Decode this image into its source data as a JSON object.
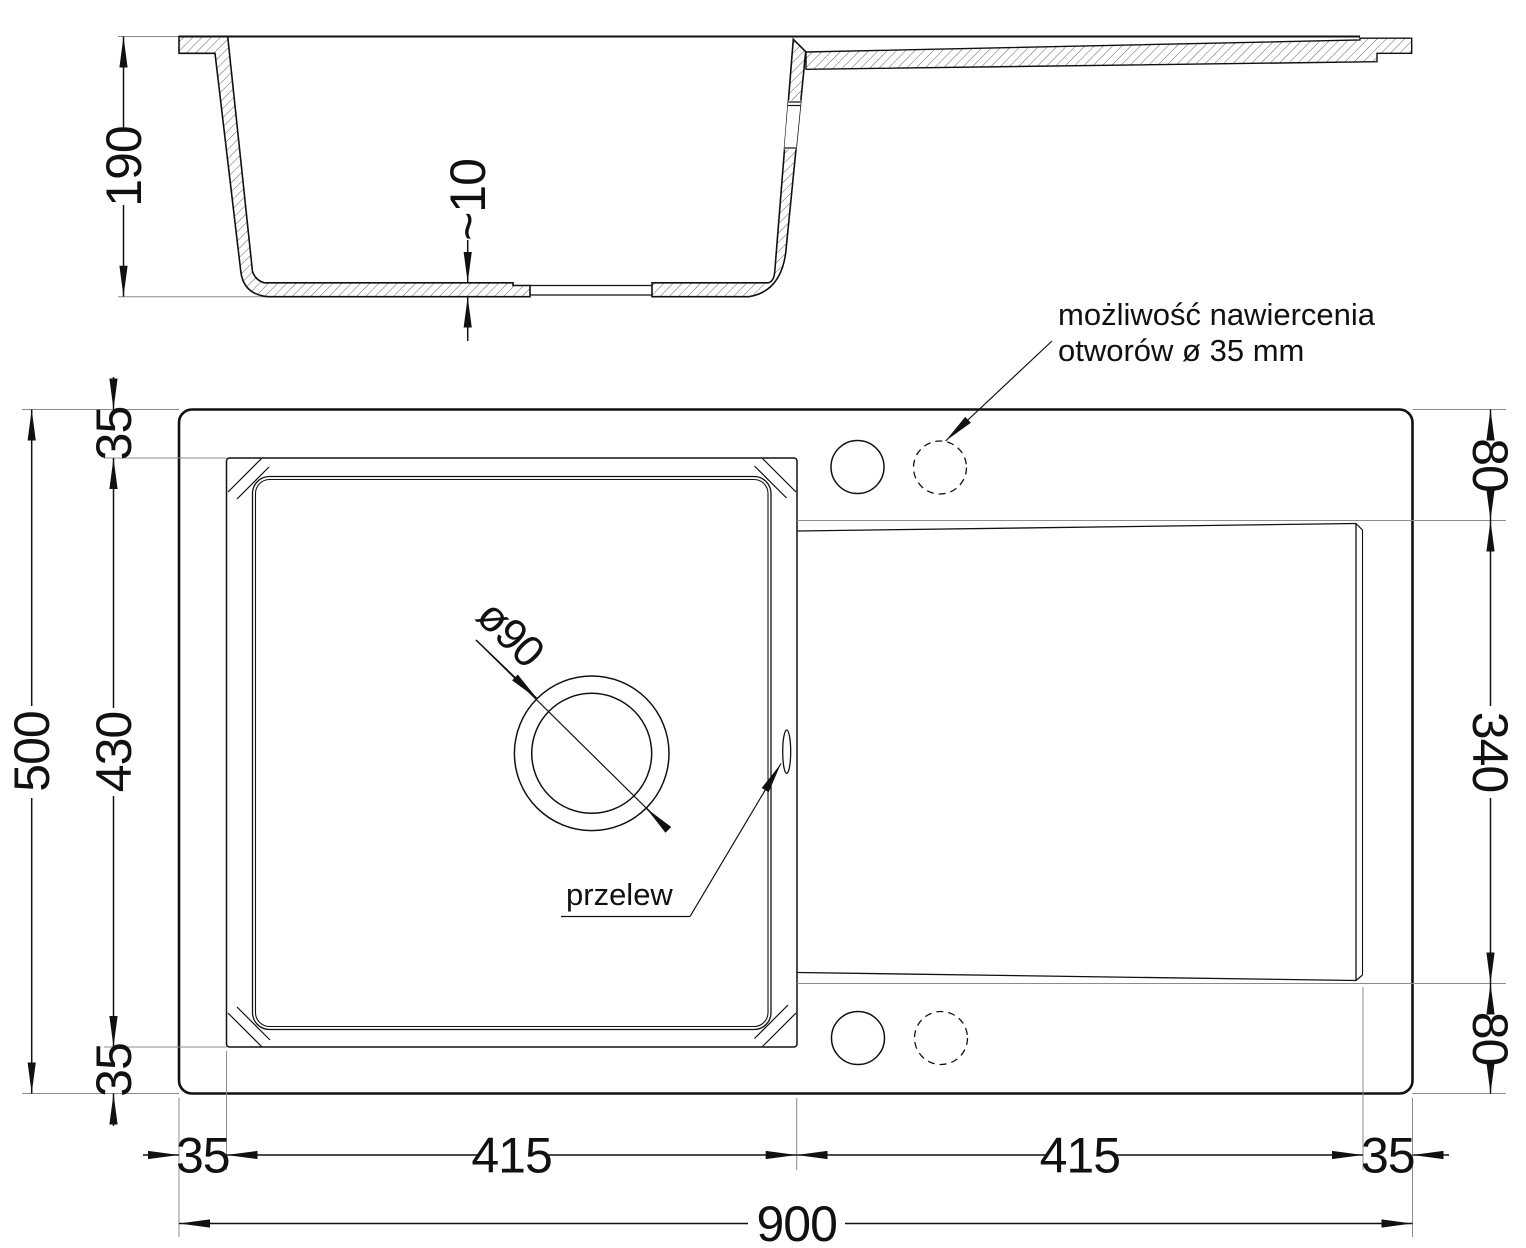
{
  "drawing": {
    "side_view": {
      "depth": "190",
      "bottom_thickness": "~10"
    },
    "plan_view": {
      "overflow_label": "przelew",
      "drain_diameter": "ø90",
      "drill_note_line1": "możliwość nawiercenia",
      "drill_note_line2": "otworów ø 35 mm"
    },
    "dimensions": {
      "total_width": "900",
      "total_height": "500",
      "bowl_width": "415",
      "drainer_width": "415",
      "left_margin": "35",
      "right_margin": "35",
      "top_margin": "35",
      "bottom_margin": "35",
      "bowl_height": "430",
      "drainer_top_offset": "80",
      "drainer_height": "340",
      "drainer_bottom_offset": "80"
    },
    "colors": {
      "line": "#111111",
      "extension": "#8c8c8c",
      "hatch": "#3c3c3c",
      "background": "#ffffff"
    }
  }
}
